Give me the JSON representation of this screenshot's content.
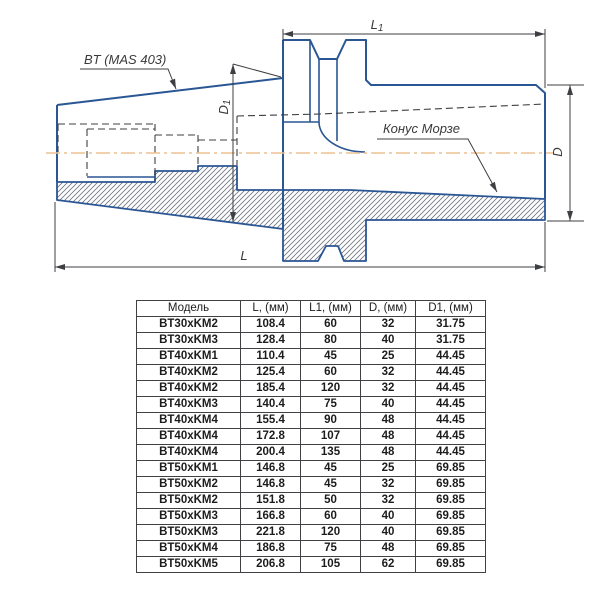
{
  "drawing": {
    "labels": {
      "shank_standard": "BT (MAS 403)",
      "morse_taper": "Конус Морзе",
      "dim_l1_base": "L",
      "dim_l1_sub": "1",
      "dim_l": "L",
      "dim_d": "D",
      "dim_d1_base": "D",
      "dim_d1_sub": "1"
    },
    "colors": {
      "outline_blue": "#2a5694",
      "line_dark": "#3d3f42",
      "centerline_orange": "#eec193"
    }
  },
  "table": {
    "columns": [
      "Модель",
      "L, (мм)",
      "L1, (мм)",
      "D, (мм)",
      "D1, (мм)"
    ],
    "rows": [
      [
        "BT30xKM2",
        "108.4",
        "60",
        "32",
        "31.75"
      ],
      [
        "BT30xKM3",
        "128.4",
        "80",
        "40",
        "31.75"
      ],
      [
        "BT40xKM1",
        "110.4",
        "45",
        "25",
        "44.45"
      ],
      [
        "BT40xKM2",
        "125.4",
        "60",
        "32",
        "44.45"
      ],
      [
        "BT40xKM2",
        "185.4",
        "120",
        "32",
        "44.45"
      ],
      [
        "BT40xKM3",
        "140.4",
        "75",
        "40",
        "44.45"
      ],
      [
        "BT40xKM4",
        "155.4",
        "90",
        "48",
        "44.45"
      ],
      [
        "BT40xKM4",
        "172.8",
        "107",
        "48",
        "44.45"
      ],
      [
        "BT40xKM4",
        "200.4",
        "135",
        "48",
        "44.45"
      ],
      [
        "BT50xKM1",
        "146.8",
        "45",
        "25",
        "69.85"
      ],
      [
        "BT50xKM2",
        "146.8",
        "45",
        "32",
        "69.85"
      ],
      [
        "BT50xKM2",
        "151.8",
        "50",
        "32",
        "69.85"
      ],
      [
        "BT50xKM3",
        "166.8",
        "60",
        "40",
        "69.85"
      ],
      [
        "BT50xKM3",
        "221.8",
        "120",
        "40",
        "69.85"
      ],
      [
        "BT50xKM4",
        "186.8",
        "75",
        "48",
        "69.85"
      ],
      [
        "BT50xKM5",
        "206.8",
        "105",
        "62",
        "69.85"
      ]
    ]
  }
}
